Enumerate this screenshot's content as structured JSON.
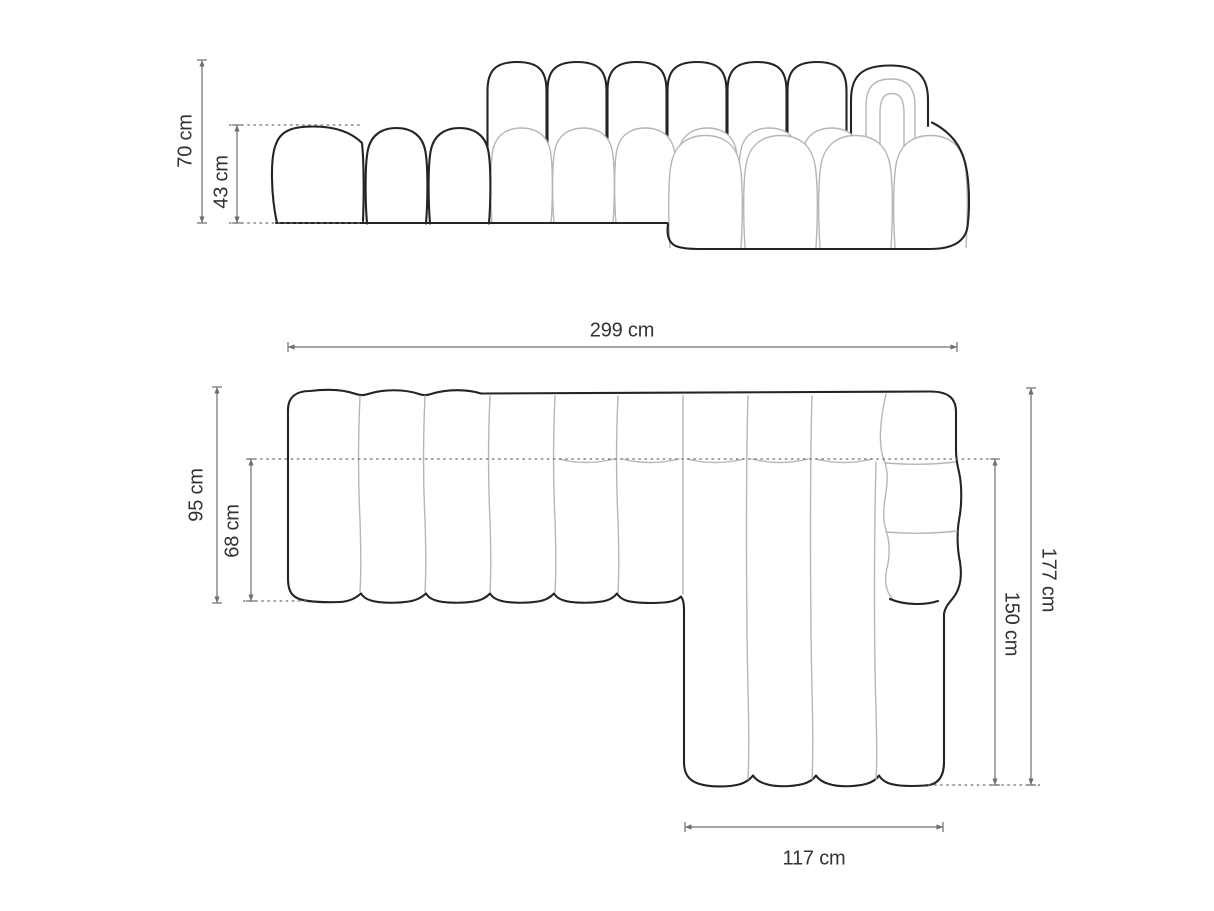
{
  "labels": {
    "front_height_total": "70 cm",
    "front_seat_height": "43 cm",
    "plan_width_total": "299 cm",
    "plan_depth_left_total": "95 cm",
    "plan_depth_left_seat": "68 cm",
    "plan_depth_right_total": "177 cm",
    "plan_chaise_length": "150 cm",
    "plan_chaise_width": "117 cm"
  },
  "measurements": {
    "unit": "cm",
    "front_view": {
      "total_height": 70,
      "seat_height": 43
    },
    "plan_view": {
      "total_width": 299,
      "left_section_depth": 95,
      "left_section_seat_depth": 68,
      "right_section_total_depth": 177,
      "chaise_length": 150,
      "chaise_width": 117
    }
  },
  "colors": {
    "outline": "#242424",
    "seam": "#b6b6b6",
    "dim": "#6e6e6e",
    "text": "#333333",
    "bg": "#ffffff"
  }
}
